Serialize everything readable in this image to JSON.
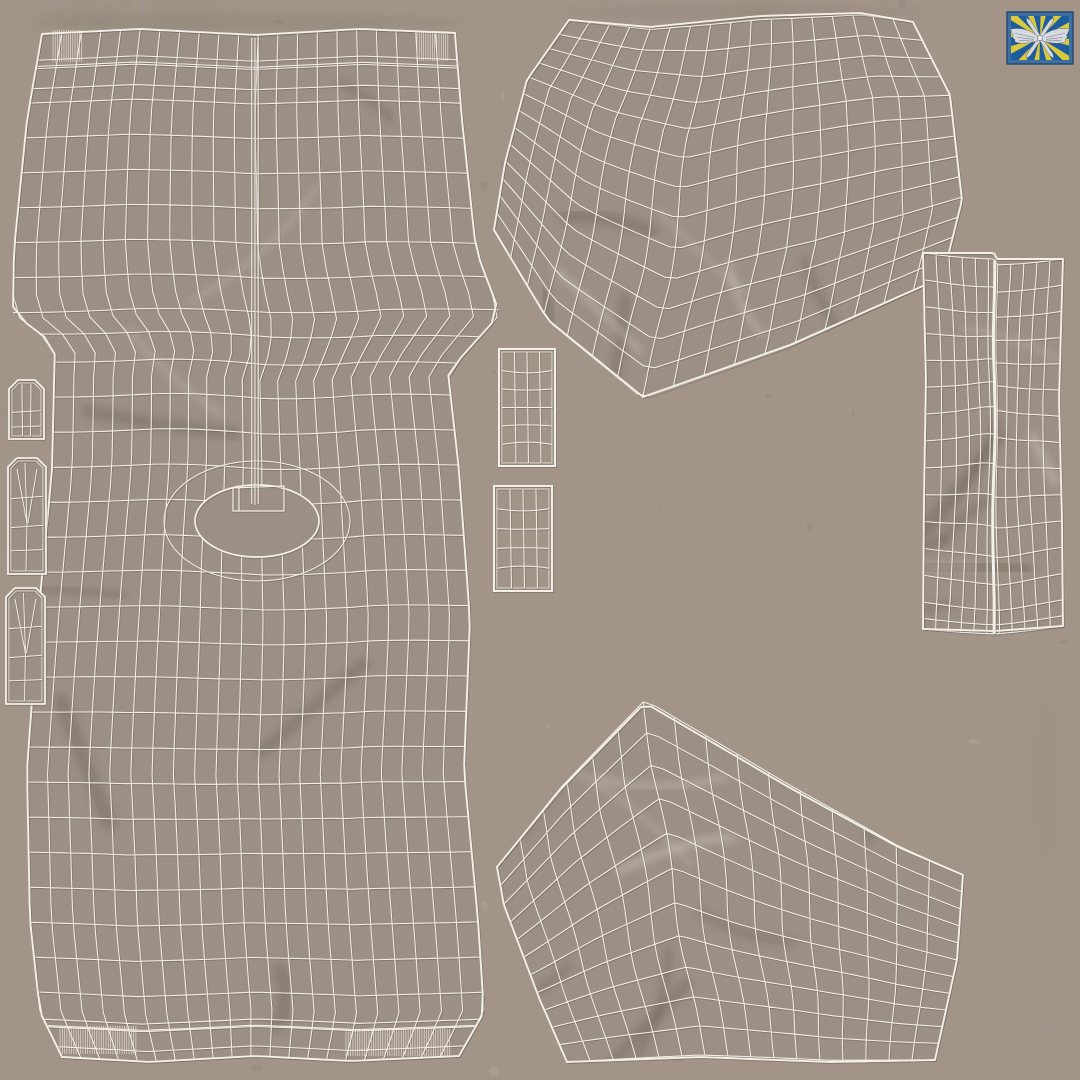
{
  "meta": {
    "title": "Trousers 3D model — UV wireframe texture sheet",
    "canvas_width": 1080,
    "canvas_height": 1080,
    "background_texture": "beige fabric with mottled stains"
  },
  "colors": {
    "background": "#a29588",
    "fabric": "#9c8f83",
    "wireframe": "#f4f0e9",
    "wireframe_shadow": "rgba(92,82,72,0.38)",
    "stain_dark": "rgba(106,93,82,0.10)",
    "stain_light": "rgba(238,232,224,0.08)",
    "flag_frame": "#3d6fa0",
    "flag_border": "#24466b",
    "flag_field": "#1d5c9f",
    "flag_rays": "#d9c93b",
    "flag_silver": "#d6dae0",
    "flag_silver_dark": "#646a72"
  },
  "logo": {
    "name": "air-force-flag-logo",
    "description": "Blue flag patch with yellow radiating rays and a silver winged-propeller emblem",
    "x": 1007,
    "y": 12,
    "width": 66,
    "height": 52
  },
  "pieces": [
    {
      "id": "front-panel",
      "label": "Front panel with fly seam, waistband and crotch opening",
      "x": 13,
      "y": 29,
      "w": 487,
      "h": 1033
    },
    {
      "id": "back-panel-upper",
      "label": "Back leg panel (upper island)",
      "x": 494,
      "y": 13,
      "w": 468,
      "h": 384
    },
    {
      "id": "side-strip",
      "label": "Side waistband strip with centre seam",
      "x": 923,
      "y": 253,
      "w": 140,
      "h": 378
    },
    {
      "id": "back-panel-lower",
      "label": "Back leg panel (lower island)",
      "x": 497,
      "y": 703,
      "w": 466,
      "h": 362
    },
    {
      "id": "pocket-facing-upper",
      "label": "Pocket facing (upper small rectangle)",
      "x": 499,
      "y": 349,
      "w": 56,
      "h": 117
    },
    {
      "id": "pocket-facing-lower",
      "label": "Pocket facing (lower small rectangle)",
      "x": 494,
      "y": 486,
      "w": 58,
      "h": 105
    },
    {
      "id": "belt-loop-short",
      "label": "Belt loop (short)",
      "x": 9,
      "y": 380,
      "w": 35,
      "h": 59
    },
    {
      "id": "belt-loop-mid",
      "label": "Belt loop (middle)",
      "x": 8,
      "y": 458,
      "w": 38,
      "h": 116
    },
    {
      "id": "belt-loop-long",
      "label": "Belt loop (lower)",
      "x": 6,
      "y": 588,
      "w": 39,
      "h": 116
    }
  ]
}
